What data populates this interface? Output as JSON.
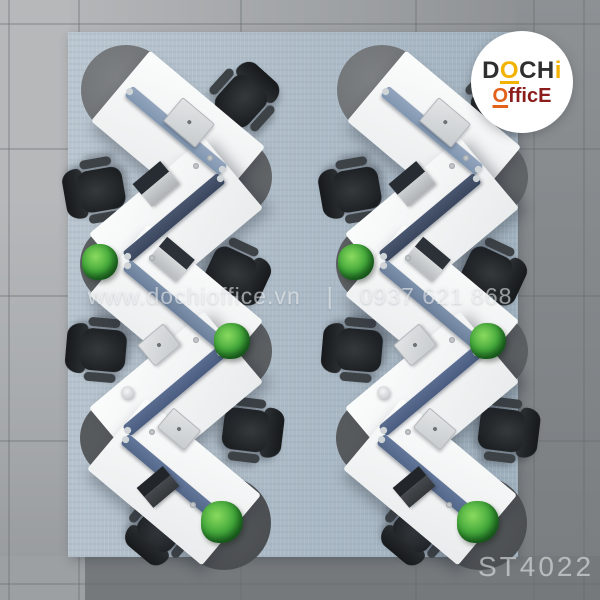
{
  "logo": {
    "word1_pre": "D",
    "word1_accent": "O",
    "word1_mid": "CH",
    "word1_accent2": "i",
    "word2_accent": "O",
    "word2_rest": "fficE"
  },
  "watermark": {
    "website": "www.dochioffice.vn",
    "separator": "|",
    "phone": "0937 621 868"
  },
  "product_code": "ST4022",
  "palette": {
    "logo_yellow": "#f3b200",
    "logo_orange": "#e2621b",
    "logo_maroon": "#8c1d1d",
    "rug_blue": "#aebcc8",
    "desk_white": "#f2f4f5",
    "end_cap_gray": "#5b5e61",
    "divider_slate": "#8a9db6",
    "divider_navy": "#3f4c63",
    "chair_black": "#25282b",
    "plant_green": "#3da23a",
    "floor_light_gray": "#b2b5b7",
    "floor_dark_gray": "#7b7f82"
  }
}
